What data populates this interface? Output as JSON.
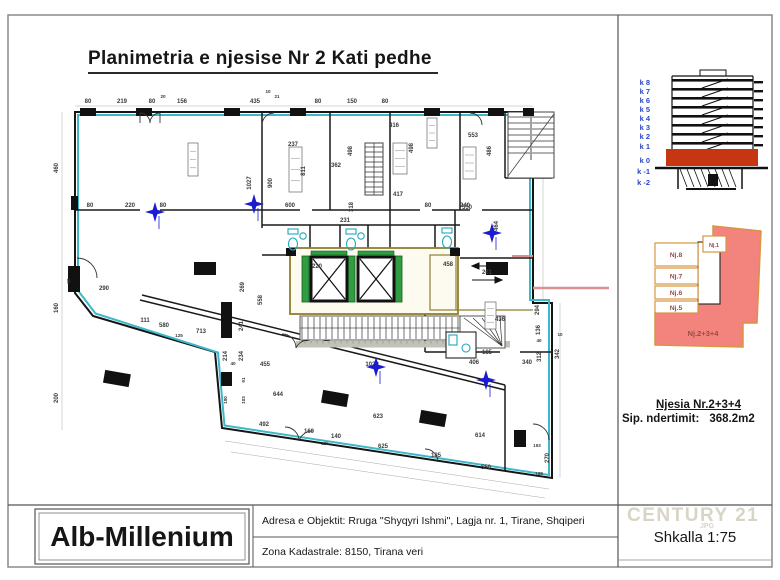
{
  "page": {
    "title": "Planimetria e njesise Nr 2   Kati pedhe"
  },
  "title_block": {
    "company": "Alb-Millenium",
    "address": "Adresa e Objektit: Rruga \"Shyqyri Ishmi\", Lagja nr. 1, Tirane, Shqiperi",
    "cadastre": "Zona Kadastrale: 8150, Tirana veri"
  },
  "sidebar": {
    "elevation": {
      "floors": [
        "k 8",
        "k 7",
        "k 6",
        "k 5",
        "k 4",
        "k 3",
        "k 2",
        "k 1",
        "k 0",
        "k -1",
        "k -2"
      ]
    },
    "unit_key": {
      "units": [
        "Nj.8",
        "Nj.7",
        "Nj.6",
        "Nj.5"
      ],
      "unit_top": "Nj.1",
      "main_unit": "Nj.2+3+4"
    },
    "unit_info": {
      "title": "Njesia  Nr.2+3+4",
      "area_label": "Sip. ndertimit:",
      "area_value": "368.2m2"
    },
    "scale_label": "Shkalla 1:75",
    "watermark": "CENTURY 21",
    "watermark_sub": "JPG"
  },
  "plan": {
    "colors": {
      "wall_cyan": "#3db8c8",
      "core_olive": "#8f7f2f",
      "elevator_green": "#2e9e40",
      "highlight_red": "#c63612",
      "pink_line": "#dd8f8f",
      "unit_fill": "#f2837d",
      "unit_outline": "#d9953f",
      "star_blue": "#1b1bd0"
    },
    "dimensions": [
      [
        "80",
        88,
        103
      ],
      [
        "219",
        122,
        103
      ],
      [
        "80",
        152,
        103
      ],
      [
        "156",
        182,
        103
      ],
      [
        "435",
        255,
        103
      ],
      [
        "80",
        318,
        103
      ],
      [
        "150",
        352,
        103
      ],
      [
        "80",
        385,
        103
      ],
      [
        "20",
        163,
        98,
        0,
        1
      ],
      [
        "10",
        268,
        93,
        0,
        1
      ],
      [
        "21",
        277,
        98,
        0,
        1
      ],
      [
        "460",
        58,
        168,
        -90
      ],
      [
        "160",
        58,
        308,
        -90
      ],
      [
        "200",
        58,
        398,
        -90
      ],
      [
        "90",
        70,
        281,
        -90,
        1
      ],
      [
        "80",
        90,
        207
      ],
      [
        "220",
        130,
        207
      ],
      [
        "80",
        163,
        207
      ],
      [
        "600",
        290,
        207
      ],
      [
        "80",
        428,
        207
      ],
      [
        "240",
        465,
        207
      ],
      [
        "1027",
        251,
        183,
        -90
      ],
      [
        "900",
        272,
        183,
        -90
      ],
      [
        "237",
        293,
        146
      ],
      [
        "811",
        305,
        171,
        -90
      ],
      [
        "362",
        336,
        167
      ],
      [
        "416",
        394,
        127
      ],
      [
        "498",
        352,
        151,
        -90
      ],
      [
        "498",
        413,
        148,
        -90
      ],
      [
        "417",
        398,
        196
      ],
      [
        "318",
        353,
        207,
        -90
      ],
      [
        "231",
        345,
        222
      ],
      [
        "553",
        473,
        137
      ],
      [
        "486",
        491,
        151,
        -90
      ],
      [
        "550",
        467,
        209
      ],
      [
        "464",
        498,
        226,
        -90
      ],
      [
        "220",
        317,
        268
      ],
      [
        "458",
        448,
        266
      ],
      [
        "261",
        487,
        274
      ],
      [
        "436",
        500,
        321
      ],
      [
        "185",
        487,
        354
      ],
      [
        "406",
        474,
        364
      ],
      [
        "340",
        527,
        364
      ],
      [
        "312",
        541,
        357,
        -90
      ],
      [
        "342",
        559,
        354,
        -90
      ],
      [
        "294",
        539,
        310,
        -90
      ],
      [
        "136",
        540,
        330,
        -90
      ],
      [
        "40",
        539,
        342,
        0,
        1
      ],
      [
        "10",
        560,
        336,
        0,
        1
      ],
      [
        "1029",
        372,
        366
      ],
      [
        "455",
        265,
        366
      ],
      [
        "40",
        233,
        365,
        0,
        1
      ],
      [
        "623",
        378,
        418
      ],
      [
        "614",
        480,
        437
      ],
      [
        "625",
        383,
        448
      ],
      [
        "185",
        436,
        457
      ],
      [
        "550",
        486,
        469
      ],
      [
        "160",
        309,
        433
      ],
      [
        "140",
        336,
        438
      ],
      [
        "125",
        325,
        445,
        0,
        1
      ],
      [
        "168",
        539,
        475,
        0,
        1
      ],
      [
        "193",
        537,
        447,
        0,
        1
      ],
      [
        "270",
        549,
        458,
        -90
      ],
      [
        "290",
        104,
        290
      ],
      [
        "111",
        145,
        322
      ],
      [
        "580",
        164,
        327
      ],
      [
        "125",
        179,
        337,
        0,
        1
      ],
      [
        "713",
        201,
        333
      ],
      [
        "214",
        227,
        356,
        -90
      ],
      [
        "234",
        243,
        356,
        -90
      ],
      [
        "241",
        243,
        326,
        -90
      ],
      [
        "269",
        244,
        287,
        -90
      ],
      [
        "558",
        262,
        300,
        -90
      ],
      [
        "644",
        278,
        396
      ],
      [
        "492",
        264,
        426
      ],
      [
        "91",
        245,
        380,
        -90,
        1
      ],
      [
        "103",
        245,
        400,
        -90,
        1
      ],
      [
        "180",
        227,
        400,
        -90,
        1
      ]
    ],
    "stars": [
      [
        155,
        212
      ],
      [
        254,
        204
      ],
      [
        492,
        233
      ],
      [
        376,
        367
      ],
      [
        486,
        380
      ]
    ]
  }
}
